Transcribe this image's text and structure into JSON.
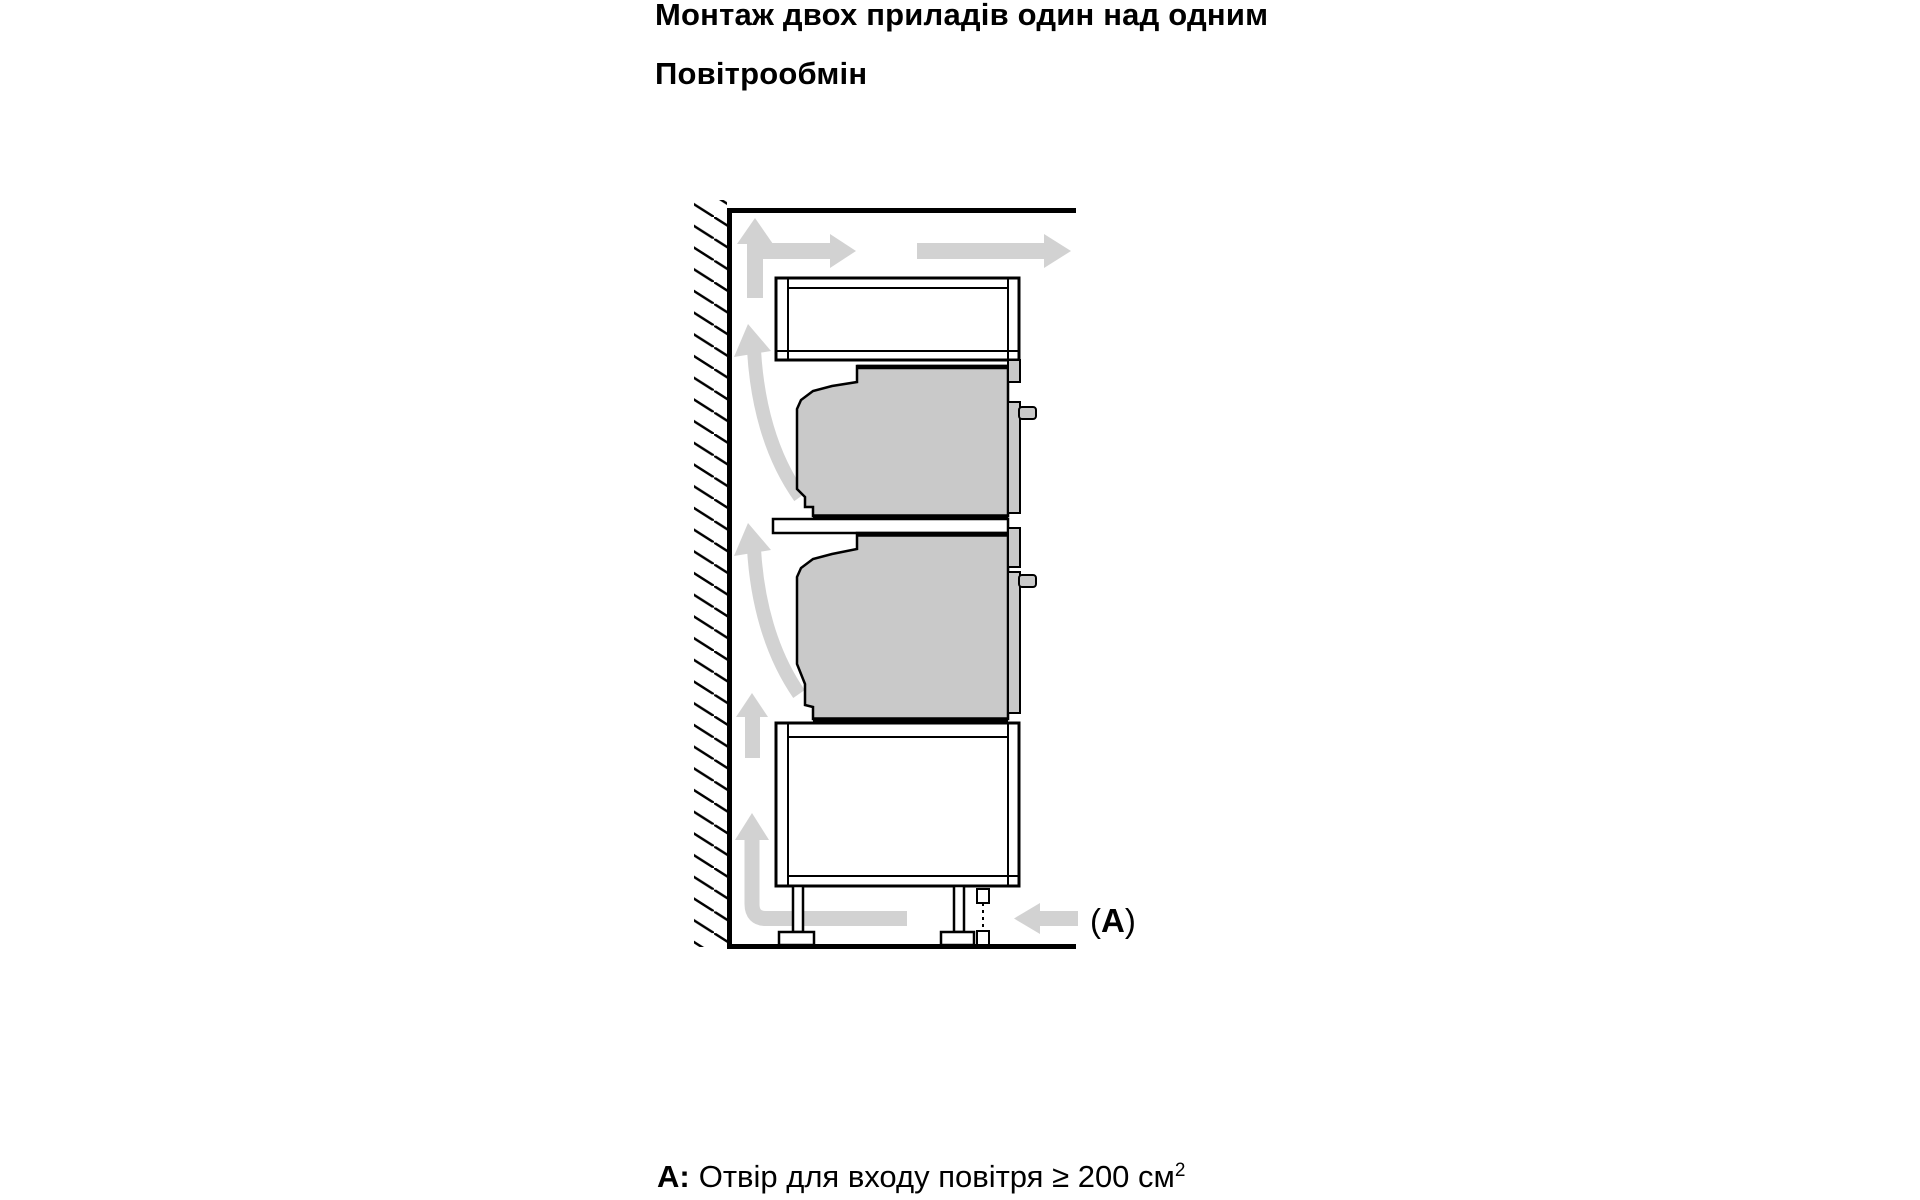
{
  "texts": {
    "title": "Монтаж двох приладів один над одним",
    "subtitle": "Повітрообмін"
  },
  "caption": {
    "prefix": "A:",
    "body": "Отвір для входу повітря ≥ 200 см",
    "superscript": "2"
  },
  "inlet_label": {
    "open": "(",
    "letter": "A",
    "close": ")"
  },
  "icons": {
    "airflow_arrows": "air circulation arrows along wall, ceiling and floor",
    "hatching": "wall section hatching"
  },
  "colors": {
    "appliance_fill": "#c9c9c9",
    "airflow_arrow": "#d2d2d2",
    "outline": "#000000",
    "background": "#ffffff"
  }
}
